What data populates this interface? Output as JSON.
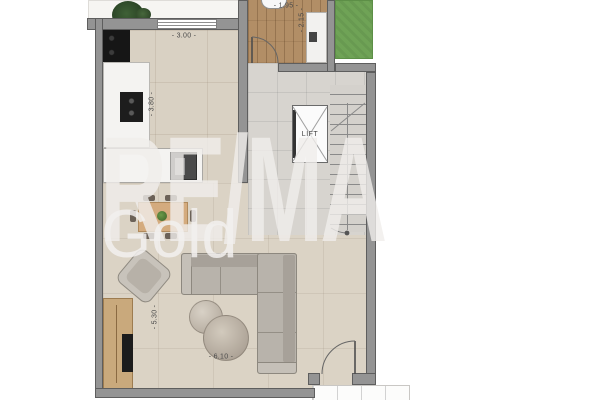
{
  "watermark": {
    "brand": "RE/MA",
    "sub": "Gold"
  },
  "labels": {
    "lift": "LIFT"
  },
  "dimensions": {
    "kitchen_width": "- 3.00 -",
    "kitchen_depth": "- 3.80 -",
    "bath_width": "- 1.95 -",
    "bath_depth": "- 2.15 -",
    "living_depth": "- 5.30 -",
    "living_width": "- 6.10 -"
  },
  "colors": {
    "wall": "#949494",
    "floor_tile": "#d9d1c3",
    "hall_tile": "#d7d4cf",
    "wood_floor": "#b28e66",
    "garden_green": "#6fa356",
    "counter_white": "#f4f3f1",
    "sofa_gray": "#b8b3ab",
    "furniture_wood": "#c9a97c",
    "watermark": "#f0eeeb"
  }
}
